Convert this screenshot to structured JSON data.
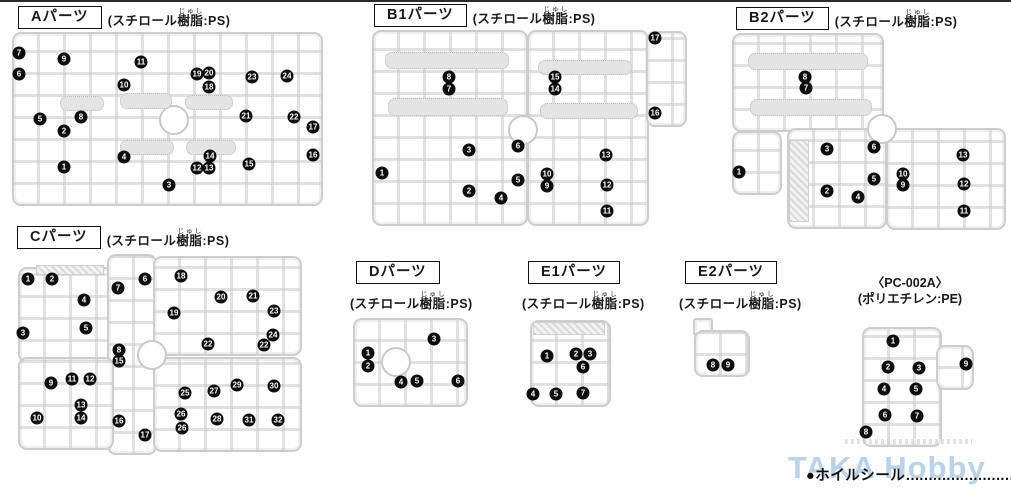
{
  "headers": {
    "a": {
      "label": "Aパーツ",
      "mat_pre": "(スチロール",
      "mat_ruby": "樹脂",
      "mat_rt": "じゅし",
      "mat_post": ":PS)"
    },
    "b1": {
      "label": "B1パーツ",
      "mat_pre": "(スチロール",
      "mat_ruby": "樹脂",
      "mat_rt": "じゅし",
      "mat_post": ":PS)"
    },
    "b2": {
      "label": "B2パーツ",
      "mat_pre": "(スチロール",
      "mat_ruby": "樹脂",
      "mat_rt": "じゅし",
      "mat_post": ":PS)"
    },
    "c": {
      "label": "Cパーツ",
      "mat_pre": "(スチロール",
      "mat_ruby": "樹脂",
      "mat_rt": "じゅし",
      "mat_post": ":PS)"
    },
    "d": {
      "label": "Dパーツ",
      "mat_pre": "(スチロール",
      "mat_ruby": "樹脂",
      "mat_rt": "じゅし",
      "mat_post": ":PS)"
    },
    "e1": {
      "label": "E1パーツ",
      "mat_pre": "(スチロール",
      "mat_ruby": "樹脂",
      "mat_rt": "じゅし",
      "mat_post": ":PS)"
    },
    "e2": {
      "label": "E2パーツ",
      "mat_pre": "(スチロール",
      "mat_ruby": "樹脂",
      "mat_rt": "じゅし",
      "mat_post": ":PS)"
    },
    "pc": {
      "line1": "〈PC-002A〉",
      "line2": "(ポリエチレン:PE)"
    }
  },
  "footer": {
    "label": "●ホイルシール",
    "dots": "……………………",
    "page_number": "1",
    "watermark": "TAKA Hobby"
  },
  "runners": {
    "a": {
      "badges": [
        {
          "n": "7",
          "x": 19,
          "y": 53
        },
        {
          "n": "9",
          "x": 64,
          "y": 59
        },
        {
          "n": "11",
          "x": 141,
          "y": 62
        },
        {
          "n": "19",
          "x": 197,
          "y": 74
        },
        {
          "n": "20",
          "x": 209,
          "y": 73
        },
        {
          "n": "23",
          "x": 252,
          "y": 77
        },
        {
          "n": "24",
          "x": 287,
          "y": 76
        },
        {
          "n": "6",
          "x": 19,
          "y": 74
        },
        {
          "n": "10",
          "x": 124,
          "y": 85
        },
        {
          "n": "18",
          "x": 209,
          "y": 87
        },
        {
          "n": "5",
          "x": 40,
          "y": 119
        },
        {
          "n": "8",
          "x": 81,
          "y": 117
        },
        {
          "n": "21",
          "x": 246,
          "y": 116
        },
        {
          "n": "22",
          "x": 294,
          "y": 117
        },
        {
          "n": "17",
          "x": 313,
          "y": 127
        },
        {
          "n": "2",
          "x": 64,
          "y": 131
        },
        {
          "n": "4",
          "x": 124,
          "y": 157
        },
        {
          "n": "14",
          "x": 210,
          "y": 156
        },
        {
          "n": "16",
          "x": 313,
          "y": 155
        },
        {
          "n": "1",
          "x": 64,
          "y": 167
        },
        {
          "n": "12",
          "x": 197,
          "y": 168
        },
        {
          "n": "13",
          "x": 209,
          "y": 168
        },
        {
          "n": "15",
          "x": 249,
          "y": 164
        },
        {
          "n": "3",
          "x": 169,
          "y": 185
        }
      ]
    },
    "b1": {
      "badges": [
        {
          "n": "8",
          "x": 449,
          "y": 77
        },
        {
          "n": "7",
          "x": 449,
          "y": 89
        },
        {
          "n": "15",
          "x": 555,
          "y": 77
        },
        {
          "n": "14",
          "x": 555,
          "y": 89
        },
        {
          "n": "17",
          "x": 655,
          "y": 38
        },
        {
          "n": "16",
          "x": 655,
          "y": 113
        },
        {
          "n": "1",
          "x": 382,
          "y": 173
        },
        {
          "n": "3",
          "x": 469,
          "y": 150
        },
        {
          "n": "6",
          "x": 518,
          "y": 146
        },
        {
          "n": "13",
          "x": 606,
          "y": 155
        },
        {
          "n": "10",
          "x": 547,
          "y": 174
        },
        {
          "n": "9",
          "x": 547,
          "y": 186
        },
        {
          "n": "12",
          "x": 607,
          "y": 185
        },
        {
          "n": "2",
          "x": 469,
          "y": 191
        },
        {
          "n": "5",
          "x": 518,
          "y": 180
        },
        {
          "n": "4",
          "x": 501,
          "y": 198
        },
        {
          "n": "11",
          "x": 607,
          "y": 211
        }
      ]
    },
    "b2": {
      "badges": [
        {
          "n": "8",
          "x": 805,
          "y": 77
        },
        {
          "n": "7",
          "x": 806,
          "y": 88
        },
        {
          "n": "1",
          "x": 739,
          "y": 172
        },
        {
          "n": "3",
          "x": 827,
          "y": 149
        },
        {
          "n": "6",
          "x": 874,
          "y": 147
        },
        {
          "n": "13",
          "x": 963,
          "y": 155
        },
        {
          "n": "10",
          "x": 903,
          "y": 174
        },
        {
          "n": "9",
          "x": 903,
          "y": 185
        },
        {
          "n": "12",
          "x": 964,
          "y": 184
        },
        {
          "n": "2",
          "x": 827,
          "y": 191
        },
        {
          "n": "5",
          "x": 874,
          "y": 179
        },
        {
          "n": "4",
          "x": 858,
          "y": 197
        },
        {
          "n": "11",
          "x": 964,
          "y": 211
        }
      ]
    },
    "c": {
      "badges": [
        {
          "n": "1",
          "x": 28,
          "y": 279
        },
        {
          "n": "2",
          "x": 52,
          "y": 279
        },
        {
          "n": "4",
          "x": 84,
          "y": 300
        },
        {
          "n": "7",
          "x": 118,
          "y": 288
        },
        {
          "n": "6",
          "x": 145,
          "y": 279
        },
        {
          "n": "18",
          "x": 181,
          "y": 276
        },
        {
          "n": "20",
          "x": 221,
          "y": 297
        },
        {
          "n": "21",
          "x": 253,
          "y": 296
        },
        {
          "n": "3",
          "x": 23,
          "y": 333
        },
        {
          "n": "5",
          "x": 86,
          "y": 328
        },
        {
          "n": "19",
          "x": 174,
          "y": 313
        },
        {
          "n": "23",
          "x": 274,
          "y": 311
        },
        {
          "n": "24",
          "x": 273,
          "y": 335
        },
        {
          "n": "22",
          "x": 208,
          "y": 344
        },
        {
          "n": "22",
          "x": 264,
          "y": 345
        },
        {
          "n": "8",
          "x": 119,
          "y": 350
        },
        {
          "n": "15",
          "x": 119,
          "y": 361
        },
        {
          "n": "9",
          "x": 51,
          "y": 383
        },
        {
          "n": "11",
          "x": 72,
          "y": 379
        },
        {
          "n": "12",
          "x": 90,
          "y": 379
        },
        {
          "n": "25",
          "x": 185,
          "y": 393
        },
        {
          "n": "27",
          "x": 214,
          "y": 391
        },
        {
          "n": "29",
          "x": 237,
          "y": 385
        },
        {
          "n": "30",
          "x": 274,
          "y": 386
        },
        {
          "n": "10",
          "x": 37,
          "y": 418
        },
        {
          "n": "13",
          "x": 81,
          "y": 405
        },
        {
          "n": "14",
          "x": 81,
          "y": 418
        },
        {
          "n": "26",
          "x": 181,
          "y": 414
        },
        {
          "n": "26",
          "x": 182,
          "y": 428
        },
        {
          "n": "28",
          "x": 217,
          "y": 419
        },
        {
          "n": "31",
          "x": 249,
          "y": 420
        },
        {
          "n": "32",
          "x": 278,
          "y": 420
        },
        {
          "n": "16",
          "x": 119,
          "y": 421
        },
        {
          "n": "17",
          "x": 145,
          "y": 435
        }
      ]
    },
    "d": {
      "badges": [
        {
          "n": "1",
          "x": 368,
          "y": 353
        },
        {
          "n": "2",
          "x": 368,
          "y": 366
        },
        {
          "n": "3",
          "x": 434,
          "y": 339
        },
        {
          "n": "4",
          "x": 401,
          "y": 382
        },
        {
          "n": "5",
          "x": 417,
          "y": 381
        },
        {
          "n": "6",
          "x": 458,
          "y": 381
        }
      ]
    },
    "e1": {
      "badges": [
        {
          "n": "1",
          "x": 547,
          "y": 356
        },
        {
          "n": "2",
          "x": 576,
          "y": 354
        },
        {
          "n": "3",
          "x": 590,
          "y": 354
        },
        {
          "n": "6",
          "x": 583,
          "y": 367
        },
        {
          "n": "4",
          "x": 533,
          "y": 394
        },
        {
          "n": "5",
          "x": 556,
          "y": 394
        },
        {
          "n": "7",
          "x": 583,
          "y": 393
        }
      ]
    },
    "e2": {
      "badges": [
        {
          "n": "8",
          "x": 713,
          "y": 365
        },
        {
          "n": "9",
          "x": 728,
          "y": 365
        }
      ]
    },
    "pc": {
      "badges": [
        {
          "n": "1",
          "x": 893,
          "y": 341
        },
        {
          "n": "2",
          "x": 888,
          "y": 367
        },
        {
          "n": "3",
          "x": 919,
          "y": 368
        },
        {
          "n": "9",
          "x": 966,
          "y": 364
        },
        {
          "n": "4",
          "x": 884,
          "y": 389
        },
        {
          "n": "5",
          "x": 916,
          "y": 389
        },
        {
          "n": "6",
          "x": 885,
          "y": 415
        },
        {
          "n": "7",
          "x": 917,
          "y": 416
        },
        {
          "n": "8",
          "x": 866,
          "y": 432
        }
      ]
    }
  }
}
